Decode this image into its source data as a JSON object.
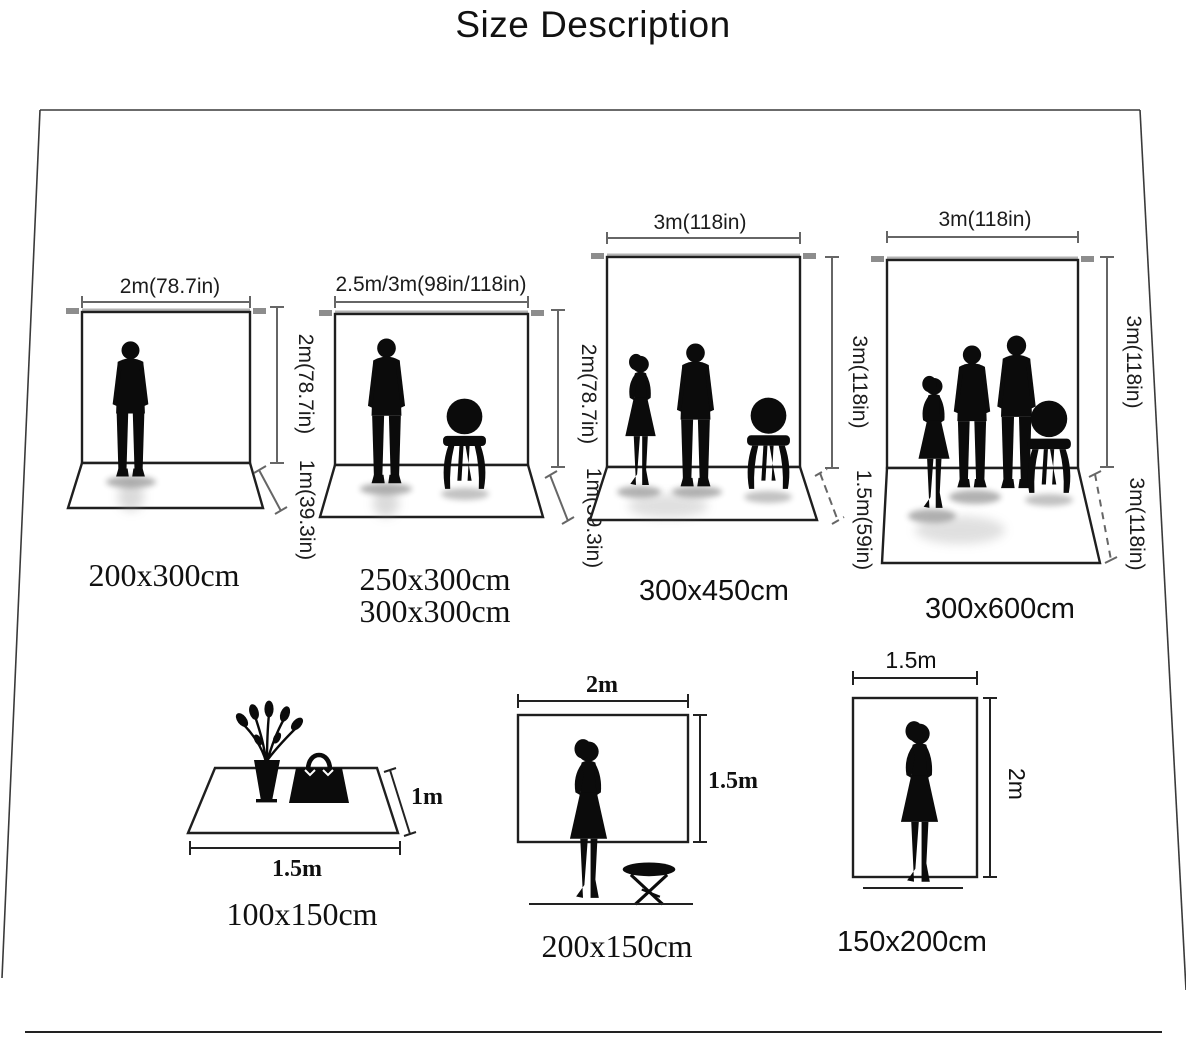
{
  "title": "Size Description",
  "backdrops": [
    {
      "width_label": "2m(78.7in)",
      "height_label": "2m(78.7in)",
      "floor_label": "1m(39.3in)",
      "size_label": "200x300cm"
    },
    {
      "width_label": "2.5m/3m(98in/118in)",
      "height_label": "2m(78.7in)",
      "floor_label": "1m(39.3in)",
      "size_label": "250x300cm",
      "size_label_2": "300x300cm"
    },
    {
      "width_label": "3m(118in)",
      "height_label": "3m(118in)",
      "floor_label": "1.5m(59in)",
      "size_label": "300x450cm"
    },
    {
      "width_label": "3m(118in)",
      "height_label": "3m(118in)",
      "floor_label": "3m(118in)",
      "size_label": "300x600cm"
    }
  ],
  "flats": [
    {
      "width_label": "1.5m",
      "height_label": "1m",
      "size_label": "100x150cm"
    },
    {
      "width_label": "2m",
      "height_label": "1.5m",
      "size_label": "200x150cm"
    },
    {
      "width_label": "1.5m",
      "height_label": "2m",
      "size_label": "150x200cm"
    }
  ],
  "colors": {
    "ink": "#1c1c1c",
    "dimension_line": "#666666",
    "pole": "#a9a9a9",
    "silhouette": "#0b0b0b"
  }
}
